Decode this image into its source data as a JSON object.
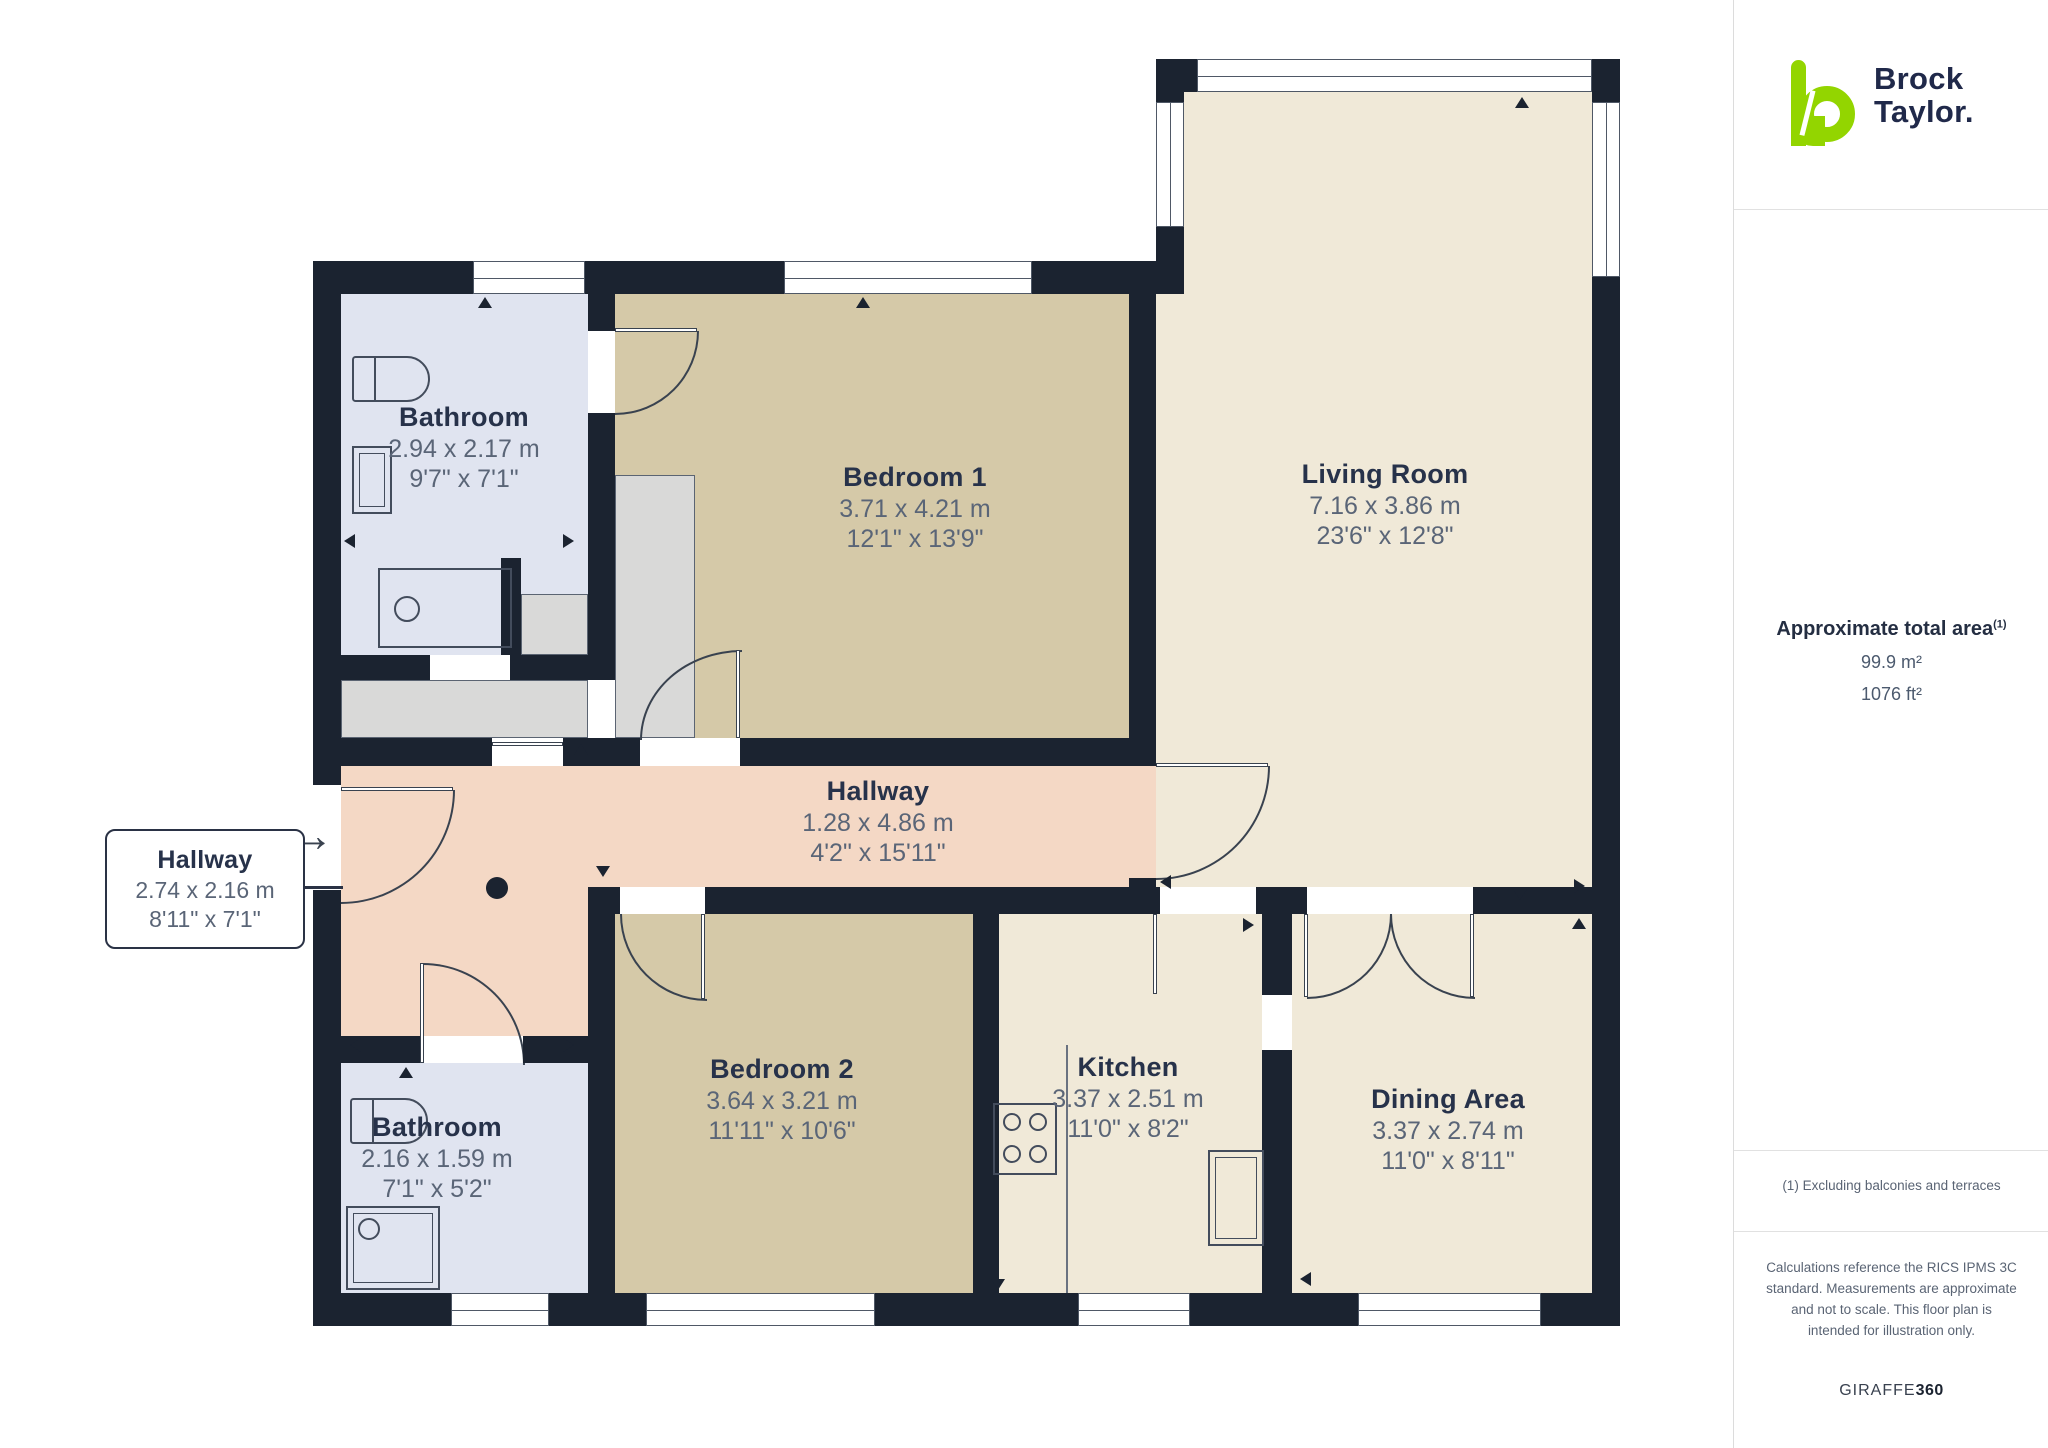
{
  "branding": {
    "name_line1": "Brock",
    "name_line2": "Taylor.",
    "logo_green": "#93d500",
    "logo_navy": "#20294a"
  },
  "sidebar": {
    "area_title": "Approximate total area",
    "area_title_sup": "(1)",
    "area_m2": "99.9 m²",
    "area_ft2": "1076 ft²",
    "footnote": "(1) Excluding balconies and terraces",
    "disclaimer": "Calculations reference the RICS IPMS 3C standard. Measurements are approximate and not to scale. This floor plan is intended for illustration only.",
    "credit_regular": "GIRAFFE",
    "credit_bold": "360"
  },
  "icons": {
    "entry_arrow": "→"
  },
  "rooms": [
    {
      "id": "bathroom-1",
      "name": "Bathroom",
      "metric": "2.94 x 2.17 m",
      "imperial": "9'7\" x 7'1\""
    },
    {
      "id": "bedroom-1",
      "name": "Bedroom 1",
      "metric": "3.71 x 4.21 m",
      "imperial": "12'1\" x 13'9\""
    },
    {
      "id": "living-room",
      "name": "Living Room",
      "metric": "7.16 x 3.86 m",
      "imperial": "23'6\" x 12'8\""
    },
    {
      "id": "hallway",
      "name": "Hallway",
      "metric": "1.28 x 4.86 m",
      "imperial": "4'2\" x 15'11\""
    },
    {
      "id": "hallway-callout",
      "name": "Hallway",
      "metric": "2.74 x 2.16 m",
      "imperial": "8'11\" x 7'1\""
    },
    {
      "id": "bedroom-2",
      "name": "Bedroom 2",
      "metric": "3.64 x 3.21 m",
      "imperial": "11'11\" x 10'6\""
    },
    {
      "id": "bathroom-2",
      "name": "Bathroom",
      "metric": "2.16 x 1.59 m",
      "imperial": "7'1\" x 5'2\""
    },
    {
      "id": "kitchen",
      "name": "Kitchen",
      "metric": "3.37 x 2.51 m",
      "imperial": "11'0\" x 8'2\""
    },
    {
      "id": "dining-area",
      "name": "Dining Area",
      "metric": "3.37 x 2.74 m",
      "imperial": "11'0\" x 8'11\""
    }
  ],
  "colors": {
    "wall": "#1b2330",
    "cream": "#f0e9d8",
    "tan": "#d5c9a8",
    "bath_blue": "#e0e4f0",
    "hall_peach": "#f4d8c5",
    "closet_grey": "#d9d9d8",
    "room_name_text": "#27324a",
    "dimension_text": "#5a6577"
  }
}
